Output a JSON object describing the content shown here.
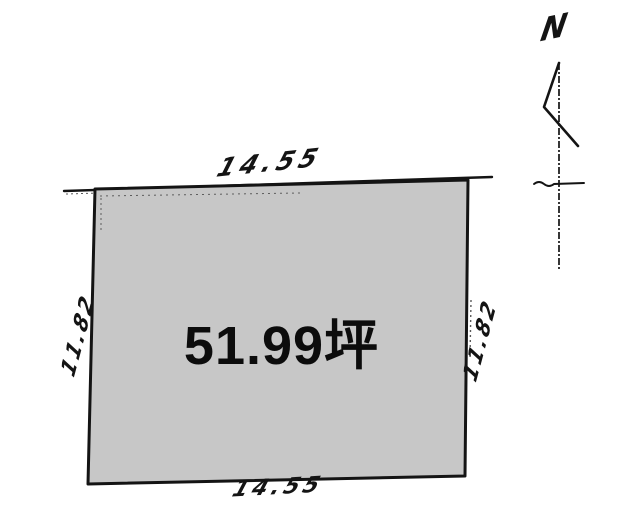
{
  "diagram": {
    "parcel": {
      "area_label": "51.99坪"
    },
    "dimensions": {
      "top": "14.55",
      "bottom": "14.55",
      "left": "11.82",
      "right": "11.82"
    },
    "compass": {
      "north_label": "N"
    },
    "colors": {
      "parcel_fill": "#c7c7c7",
      "line": "#141414",
      "background": "#ffffff"
    }
  }
}
